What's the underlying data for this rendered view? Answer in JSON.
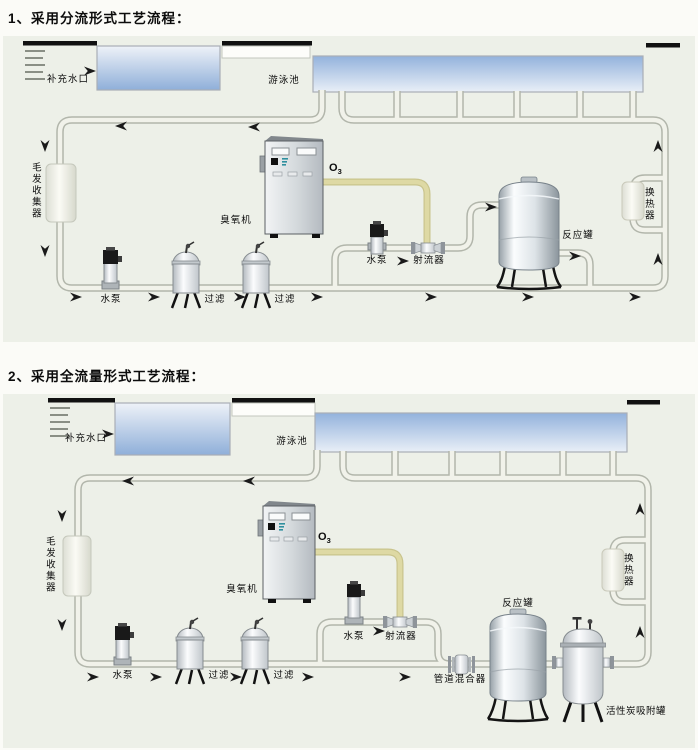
{
  "page": {
    "background": "#fbfbf7",
    "panel_background": "#edf0e8"
  },
  "colors": {
    "pipe_outline": "#b2b6ab",
    "pipe_fill": "#f1f2ea",
    "ozone_pipe_outline": "#c9c48d",
    "ozone_pipe_fill": "#ded9a4",
    "water_deep": "#8fafd9",
    "water_light": "#eaf0f8",
    "deck_bar": "#111111",
    "arrow": "#1a1a1a"
  },
  "diagram1": {
    "title": "1、采用分流形式工艺流程：",
    "labels": {
      "makeup_inlet": "补充水口",
      "pool": "游泳池",
      "hair_collector": "毛发收集器",
      "pump_main": "水泵",
      "filter_1": "过滤",
      "filter_2": "过滤",
      "ozone_generator": "臭氧机",
      "ozone_symbol": "O",
      "ozone_symbol_sub": "3",
      "pump_branch": "水泵",
      "ejector": "射流器",
      "reaction_tank": "反应罐",
      "heat_exchanger": "换热器"
    }
  },
  "diagram2": {
    "title": "2、采用全流量形式工艺流程：",
    "labels": {
      "makeup_inlet": "补充水口",
      "pool": "游泳池",
      "hair_collector": "毛发收集器",
      "pump_main": "水泵",
      "filter_1": "过滤",
      "filter_2": "过滤",
      "ozone_generator": "臭氧机",
      "ozone_symbol": "O",
      "ozone_symbol_sub": "3",
      "pump_branch": "水泵",
      "ejector": "射流器",
      "pipeline_mixer": "管道混合器",
      "reaction_tank": "反应罐",
      "carbon_tank": "活性炭吸附罐",
      "heat_exchanger": "换热器"
    }
  }
}
